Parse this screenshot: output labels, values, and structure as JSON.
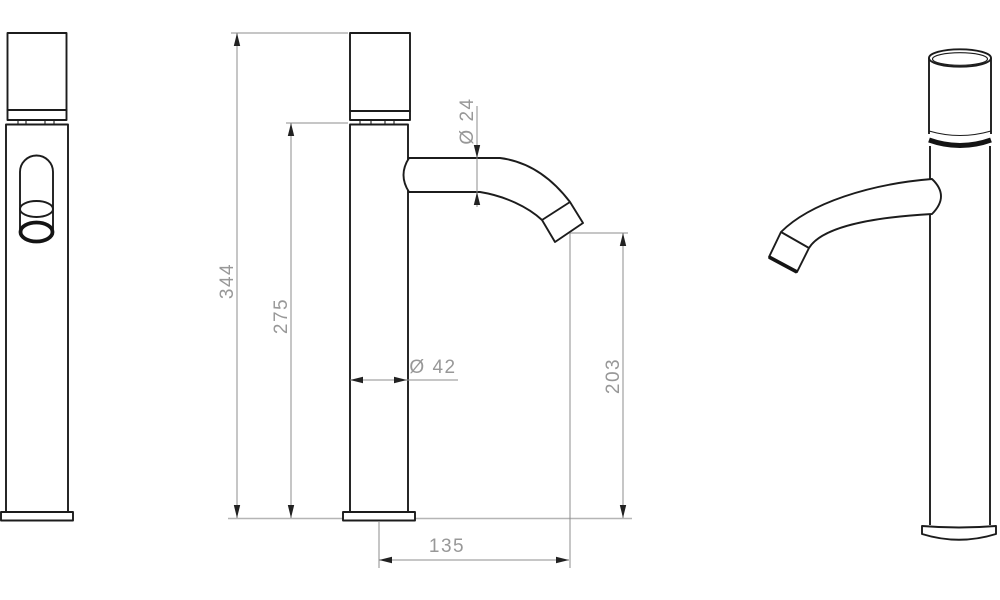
{
  "drawing": {
    "type": "technical-dimension-drawing",
    "subject": "tall single-lever basin faucet, three orthographic/perspective views",
    "colors": {
      "background": "#ffffff",
      "outline": "#1c1c1c",
      "dimension_line": "#8c8c8c",
      "dimension_text": "#989898",
      "mounting_baseline": "#b5b5b5",
      "arrow": "#222222"
    },
    "dimensions": {
      "total_height": "344",
      "body_height": "275",
      "spout_diameter": "Ø 24",
      "body_diameter": "Ø 42",
      "outlet_height": "203",
      "spout_reach": "135"
    }
  }
}
